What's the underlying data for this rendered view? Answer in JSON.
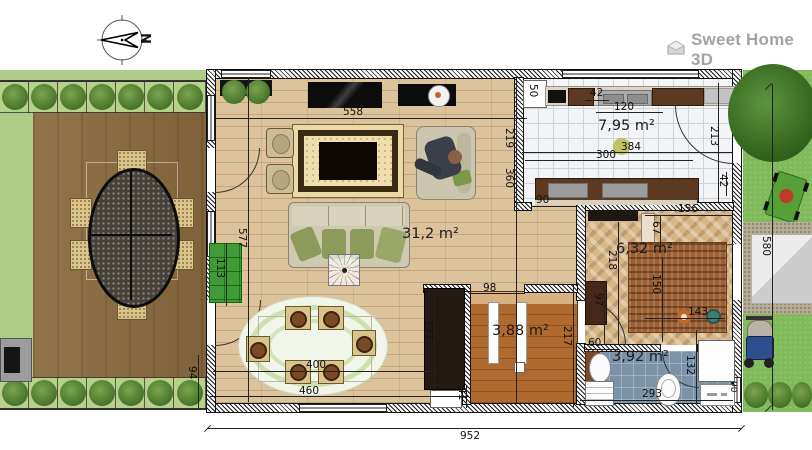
{
  "app": {
    "logo_text": "Sweet Home 3D"
  },
  "compass": {
    "north": "N"
  },
  "rooms": {
    "living_area": "31,2 m²",
    "kitchen_area": "7,95 m²",
    "cabinet_area": "6,32 m²",
    "stairs_area": "3,88 m²",
    "bathroom_area": "3,92 m²"
  },
  "dims": {
    "living_top": "558",
    "kitchen_side_upper": "219",
    "living_side_lower": "360",
    "kitchen_passage": "90",
    "fridge_width": "50",
    "counter_seg": "42",
    "sink_width": "120",
    "kitchen_counter_len": "300",
    "kitchen_width": "384",
    "kitchen_door_side": "213",
    "kitchen_door_jamb": "42",
    "cabinet_top_width": "156",
    "cabinet_jamb": "67",
    "cabinet_height": "218",
    "cabinet_door_swing": "150",
    "cabinet_door": "97",
    "cabinet_bottom": "143",
    "bath_sink": "60",
    "bath_height": "132",
    "bath_width": "293",
    "stairs_opening": "98",
    "alcove_height": "177",
    "small_cabinet": "41",
    "stairs_height": "217",
    "dining_width": "400",
    "dining_width_outer": "460",
    "living_left_height": "577",
    "green_cabinet": "113",
    "terrace_gap": "94",
    "house_width": "952",
    "garden_side": "580",
    "bath_window": "90"
  }
}
